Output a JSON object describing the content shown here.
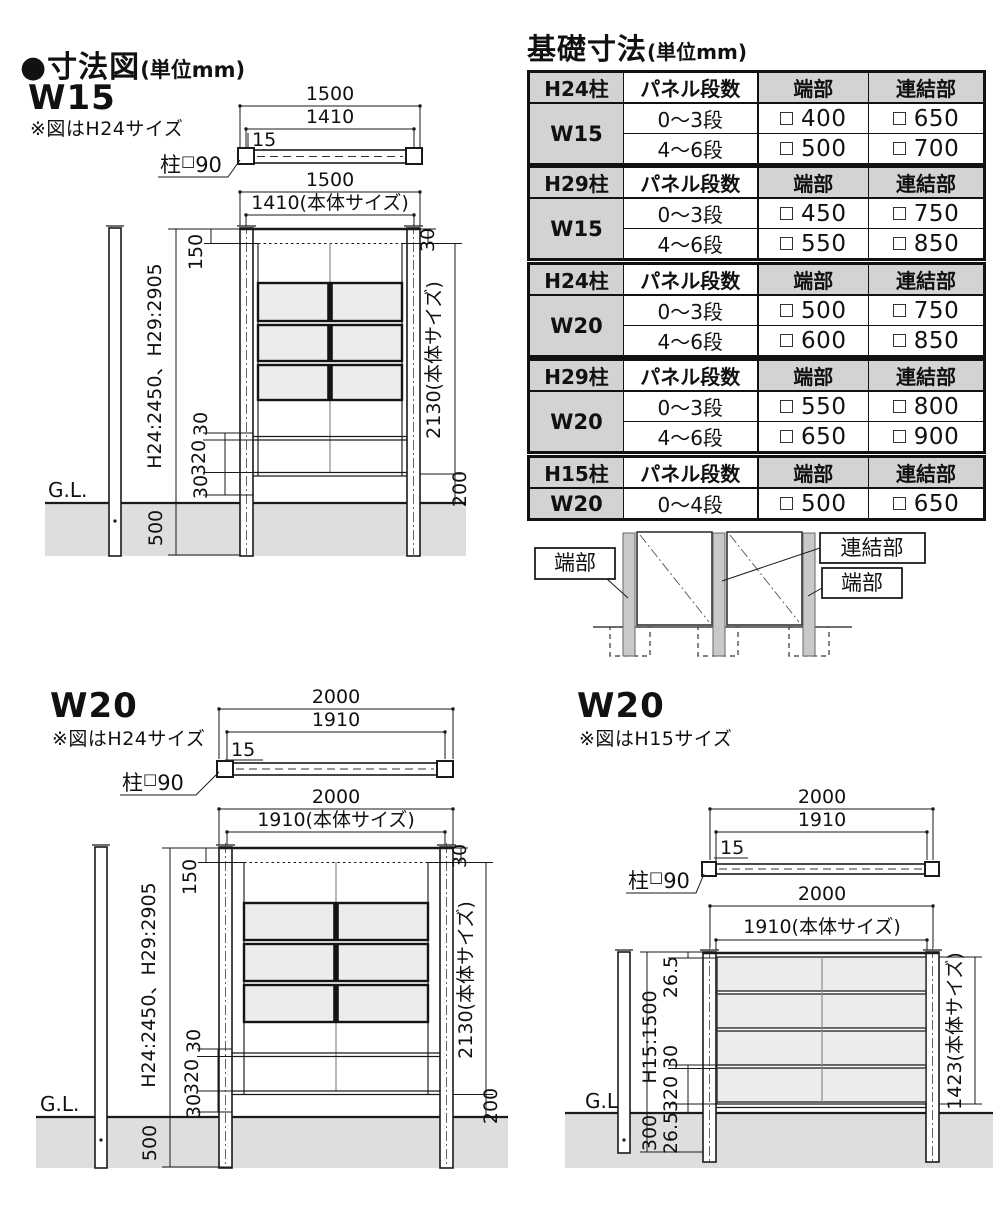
{
  "titles": {
    "dim": "●寸法図",
    "dim_unit": "(単位mm)",
    "foundation": "基礎寸法",
    "foundation_unit": "(単位mm)"
  },
  "post_label": {
    "prefix": "柱",
    "square": "□",
    "size": "90"
  },
  "sections": {
    "w15": {
      "heading": "W15",
      "note": "※図はH24サイズ",
      "plan": {
        "outer": "1500",
        "inner": "1410",
        "inset": "15"
      },
      "front": {
        "outer": "1500",
        "inner": "1410(本体サイズ)",
        "top_rail": "150",
        "top_gap": "30",
        "height": "H24:2450、H29:2905",
        "body": "2130(本体サイズ)",
        "d30a": "30",
        "d320": "320",
        "d30b": "30",
        "bottom": "200",
        "embed": "500",
        "gl": "G.L."
      }
    },
    "w20a": {
      "heading": "W20",
      "note": "※図はH24サイズ",
      "plan": {
        "outer": "2000",
        "inner": "1910",
        "inset": "15"
      },
      "front": {
        "outer": "2000",
        "inner": "1910(本体サイズ)",
        "top_rail": "150",
        "top_gap": "30",
        "height": "H24:2450、H29:2905",
        "body": "2130(本体サイズ)",
        "d30a": "30",
        "d320": "320",
        "d30b": "30",
        "bottom": "200",
        "embed": "500",
        "gl": "G.L."
      }
    },
    "w20b": {
      "heading": "W20",
      "note": "※図はH15サイズ",
      "plan": {
        "outer": "2000",
        "inner": "1910",
        "inset": "15"
      },
      "front": {
        "outer": "2000",
        "inner": "1910(本体サイズ)",
        "top_gap": "26.5",
        "height": "H15:1500",
        "d30": "30",
        "d320": "320",
        "d26": "26.5",
        "embed": "300",
        "body": "1423(本体サイズ)",
        "gl": "G.L."
      }
    }
  },
  "table_headers": {
    "steps": "パネル段数",
    "end": "端部",
    "joint": "連結部"
  },
  "tables": [
    {
      "post": "H24柱",
      "width": "W15",
      "rows": [
        {
          "steps": "0〜3段",
          "end": "400",
          "joint": "650"
        },
        {
          "steps": "4〜6段",
          "end": "500",
          "joint": "700"
        }
      ]
    },
    {
      "post": "H29柱",
      "width": "W15",
      "rows": [
        {
          "steps": "0〜3段",
          "end": "450",
          "joint": "750"
        },
        {
          "steps": "4〜6段",
          "end": "550",
          "joint": "850"
        }
      ]
    },
    {
      "post": "H24柱",
      "width": "W20",
      "rows": [
        {
          "steps": "0〜3段",
          "end": "500",
          "joint": "750"
        },
        {
          "steps": "4〜6段",
          "end": "600",
          "joint": "850"
        }
      ]
    },
    {
      "post": "H29柱",
      "width": "W20",
      "rows": [
        {
          "steps": "0〜3段",
          "end": "550",
          "joint": "800"
        },
        {
          "steps": "4〜6段",
          "end": "650",
          "joint": "900"
        }
      ]
    },
    {
      "post": "H15柱",
      "width": "W20",
      "rows": [
        {
          "steps": "0〜4段",
          "end": "500",
          "joint": "650"
        }
      ]
    }
  ],
  "joint_diagram": {
    "end_left": "端部",
    "joint_label": "連結部",
    "end_right": "端部"
  }
}
